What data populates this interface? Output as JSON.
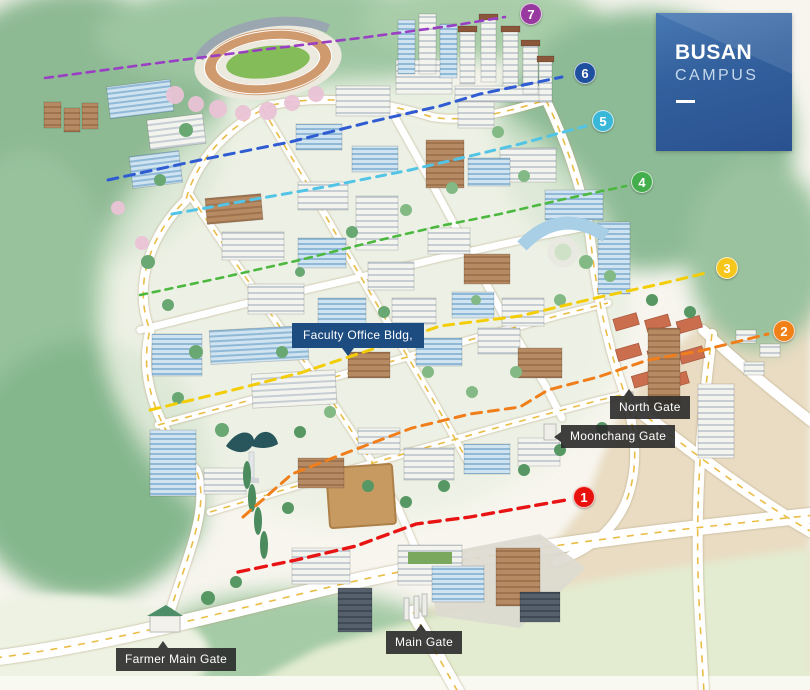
{
  "badge": {
    "title": "BUSAN",
    "subtitle": "CAMPUS"
  },
  "labels": {
    "faculty_office": "Faculty Office Bldg,",
    "north_gate": "North Gate",
    "moonchang_gate": "Moonchang Gate",
    "main_gate": "Main Gate",
    "farmer_main_gate": "Farmer Main Gate"
  },
  "markers": [
    {
      "number": "1",
      "color": "#e8110d"
    },
    {
      "number": "2",
      "color": "#f08119"
    },
    {
      "number": "3",
      "color": "#f6c61b"
    },
    {
      "number": "4",
      "color": "#44ae4c"
    },
    {
      "number": "5",
      "color": "#38b7d8"
    },
    {
      "number": "6",
      "color": "#1e509f"
    },
    {
      "number": "7",
      "color": "#97399f"
    }
  ],
  "colors": {
    "badge_bg": "#2e5a9c",
    "gate_label_bg": "#2a2a2a",
    "building_label_bg": "#1d4c80",
    "route_red": "#e81313",
    "route_orange": "#ef7e1b",
    "route_yellow": "#f2cd08",
    "route_green": "#4cb83f",
    "route_cyan": "#52c4e6",
    "route_blue": "#2f5cd2",
    "route_purple": "#9a3fc4"
  }
}
